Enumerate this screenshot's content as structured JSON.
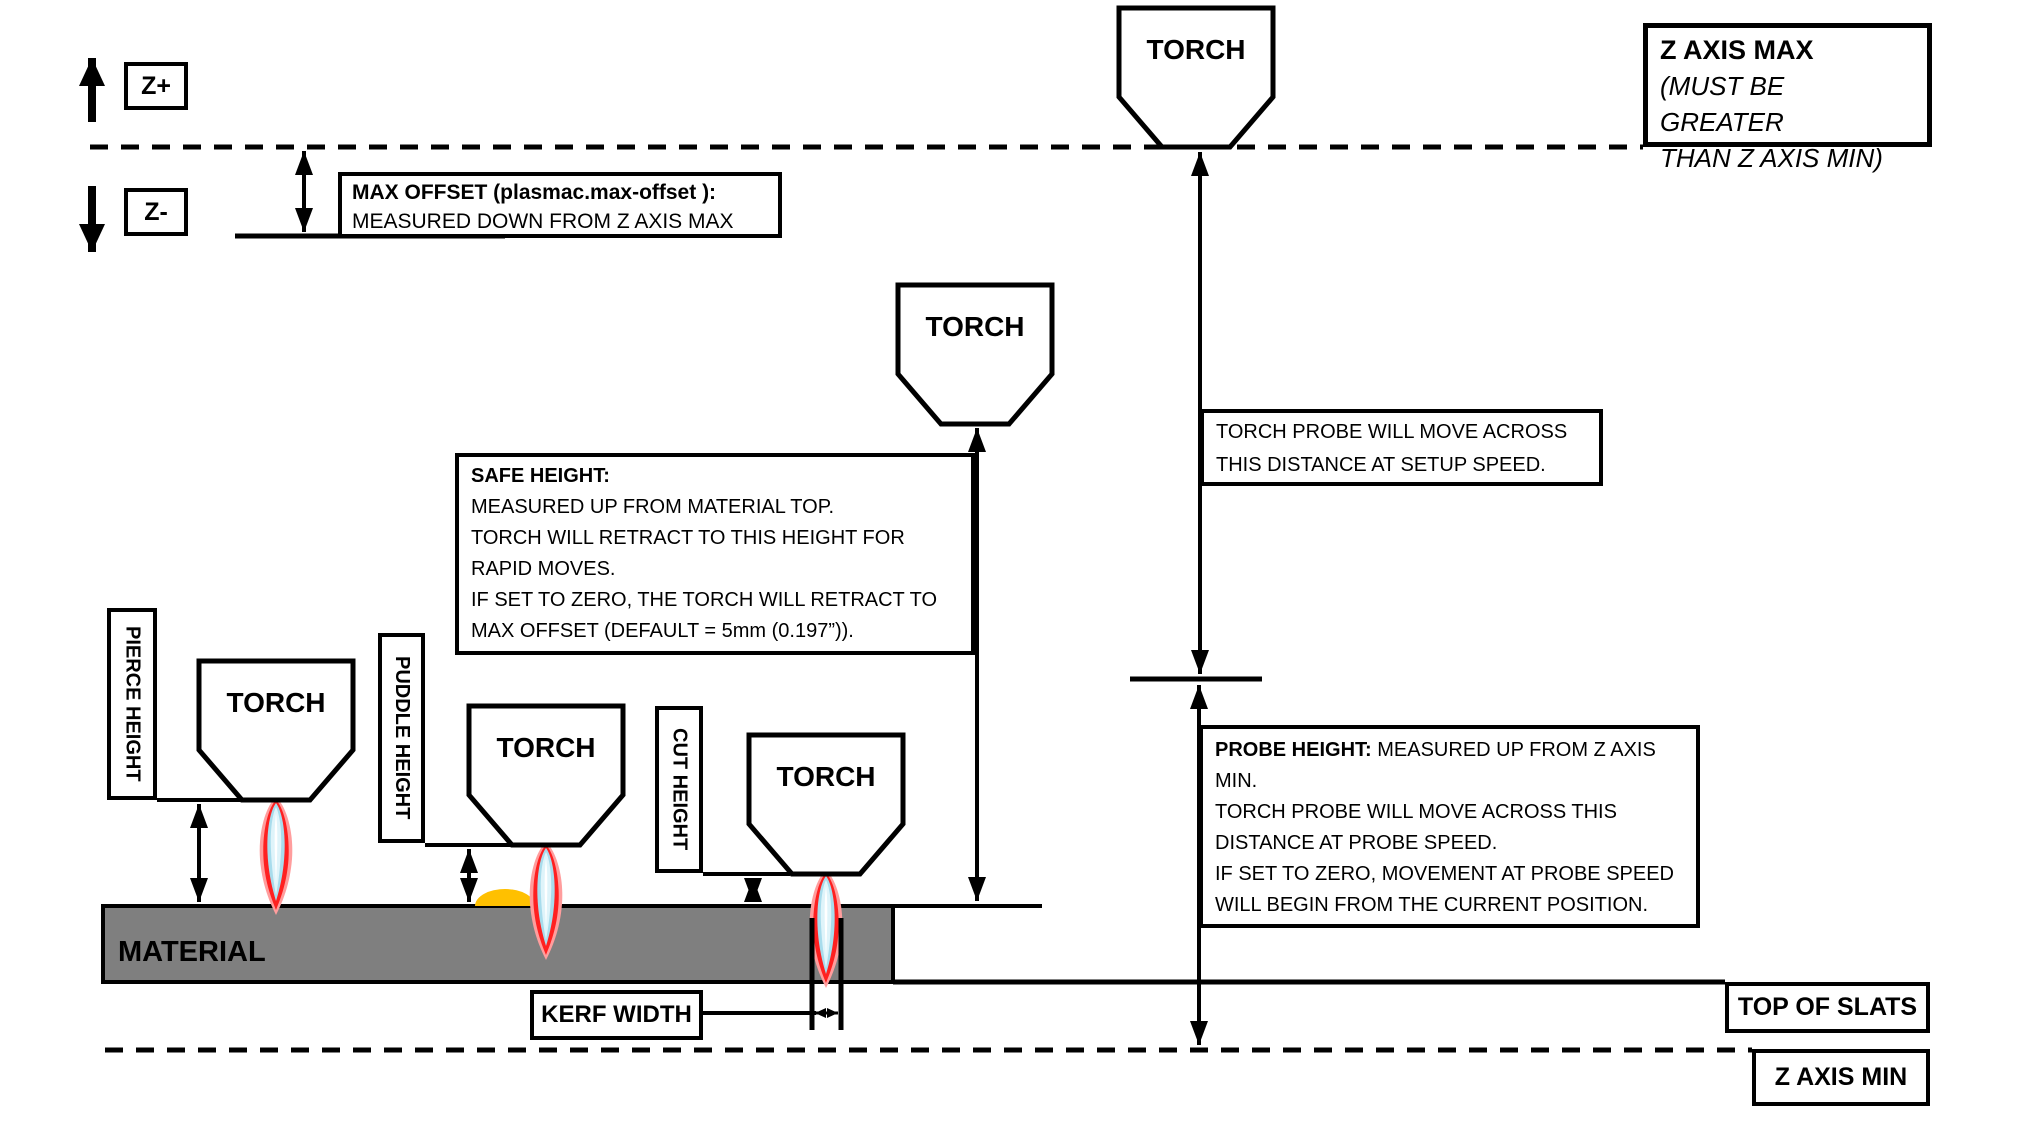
{
  "colors": {
    "line": "#000000",
    "torch_fill": "#ffffff",
    "material": "#7f7f7f",
    "puddle": "#ffc000",
    "flame_glow": "#ff9d9d",
    "flame_red": "#ff2020",
    "flame_blue": "#a8dcec",
    "flame_mid": "#dff4fa",
    "flame_core": "#ffffff"
  },
  "axis_labels": {
    "z_plus": "Z+",
    "z_minus": "Z-"
  },
  "torch_label": "TORCH",
  "material_label": "MATERIAL",
  "boxes": {
    "z_axis_max": {
      "title": "Z AXIS MAX",
      "note": "(MUST BE GREATER\nTHAN Z AXIS MIN)"
    },
    "max_offset": {
      "title": "MAX OFFSET (plasmac.max-offset ):",
      "body": "MEASURED DOWN FROM Z AXIS MAX"
    },
    "safe_height": {
      "title": "SAFE HEIGHT:",
      "body": "MEASURED UP FROM MATERIAL TOP.\nTORCH WILL RETRACT TO THIS HEIGHT FOR\nRAPID MOVES.\nIF SET TO ZERO, THE TORCH WILL RETRACT TO\nMAX OFFSET (DEFAULT = 5mm (0.197”))."
    },
    "torch_probe": {
      "body": "TORCH PROBE WILL MOVE ACROSS\nTHIS DISTANCE AT SETUP SPEED."
    },
    "probe_height": {
      "title": "PROBE HEIGHT:",
      "body": "MEASURED UP FROM Z AXIS\nMIN.\nTORCH PROBE WILL MOVE ACROSS THIS\nDISTANCE AT PROBE SPEED.\nIF SET TO ZERO, MOVEMENT AT PROBE SPEED\nWILL BEGIN FROM THE CURRENT POSITION."
    },
    "kerf_width": "KERF WIDTH",
    "top_of_slats": "TOP OF SLATS",
    "z_axis_min": "Z AXIS MIN"
  },
  "dimension_labels": {
    "pierce_height": "PIERCE HEIGHT",
    "puddle_height": "PUDDLE HEIGHT",
    "cut_height": "CUT HEIGHT"
  }
}
